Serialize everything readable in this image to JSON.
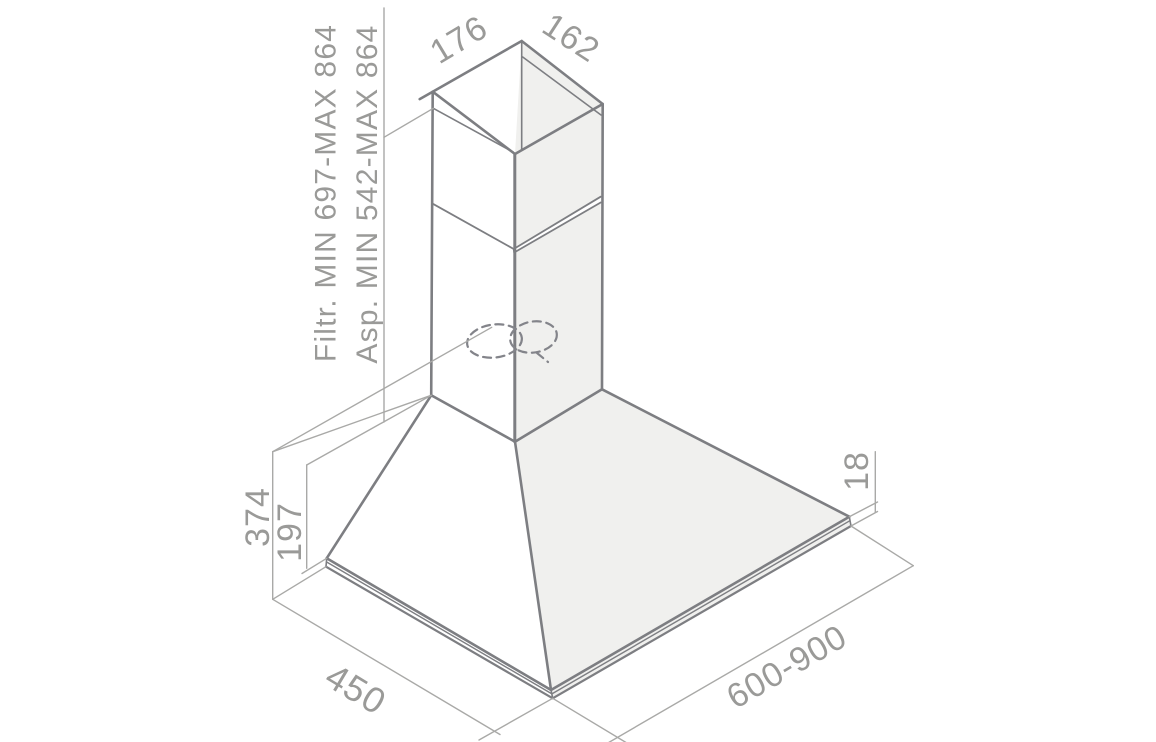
{
  "diagram": {
    "labels": {
      "top_depth": "176",
      "top_width": "162",
      "filter_height": "Filtr. MIN 697-MAX 864",
      "duct_height": "Asp. MIN 542-MAX 864",
      "body_height": "374",
      "lower_height": "197",
      "rim_thickness": "18",
      "depth": "450",
      "width_range": "600-900"
    },
    "colors": {
      "outline": "#7d7e82",
      "dimension_lines": "#a9a9a7",
      "text": "#9a9a98",
      "shading": "#f0f0ee",
      "background": "#ffffff"
    }
  }
}
